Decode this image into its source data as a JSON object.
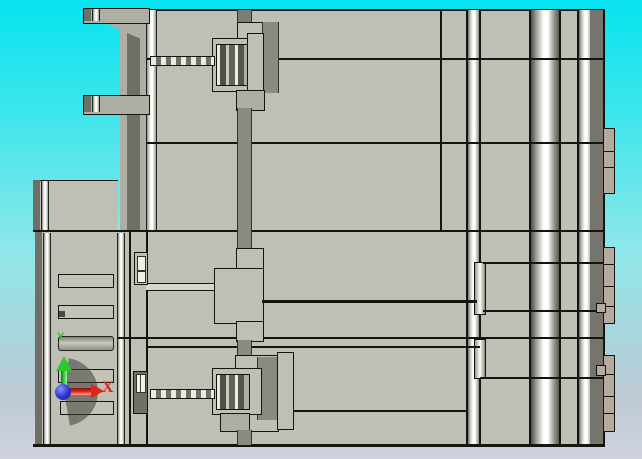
{
  "viewport": {
    "app_context": "CAD 3D viewport, orthographic side view of a mold-base style assembly",
    "triad": {
      "x_label": "X",
      "y_label": "Y"
    },
    "colors": {
      "sky-top": "#07e3ef",
      "sky-mid": "#8fe7e9",
      "sky-low": "#bdc9d4",
      "sky-bottom": "#cfd3de",
      "face": "#bfbfb5",
      "face-dark": "#aeaea4",
      "edge-dark": "#6f6f68",
      "bar-dark": "#8a8a80",
      "right-band": "#75756d",
      "tab-face": "#b4ab9e",
      "outline": "#15150f",
      "x-red": "#e1251b",
      "y-green": "#2ec82e",
      "origin-blue": "#2a35cf"
    }
  }
}
